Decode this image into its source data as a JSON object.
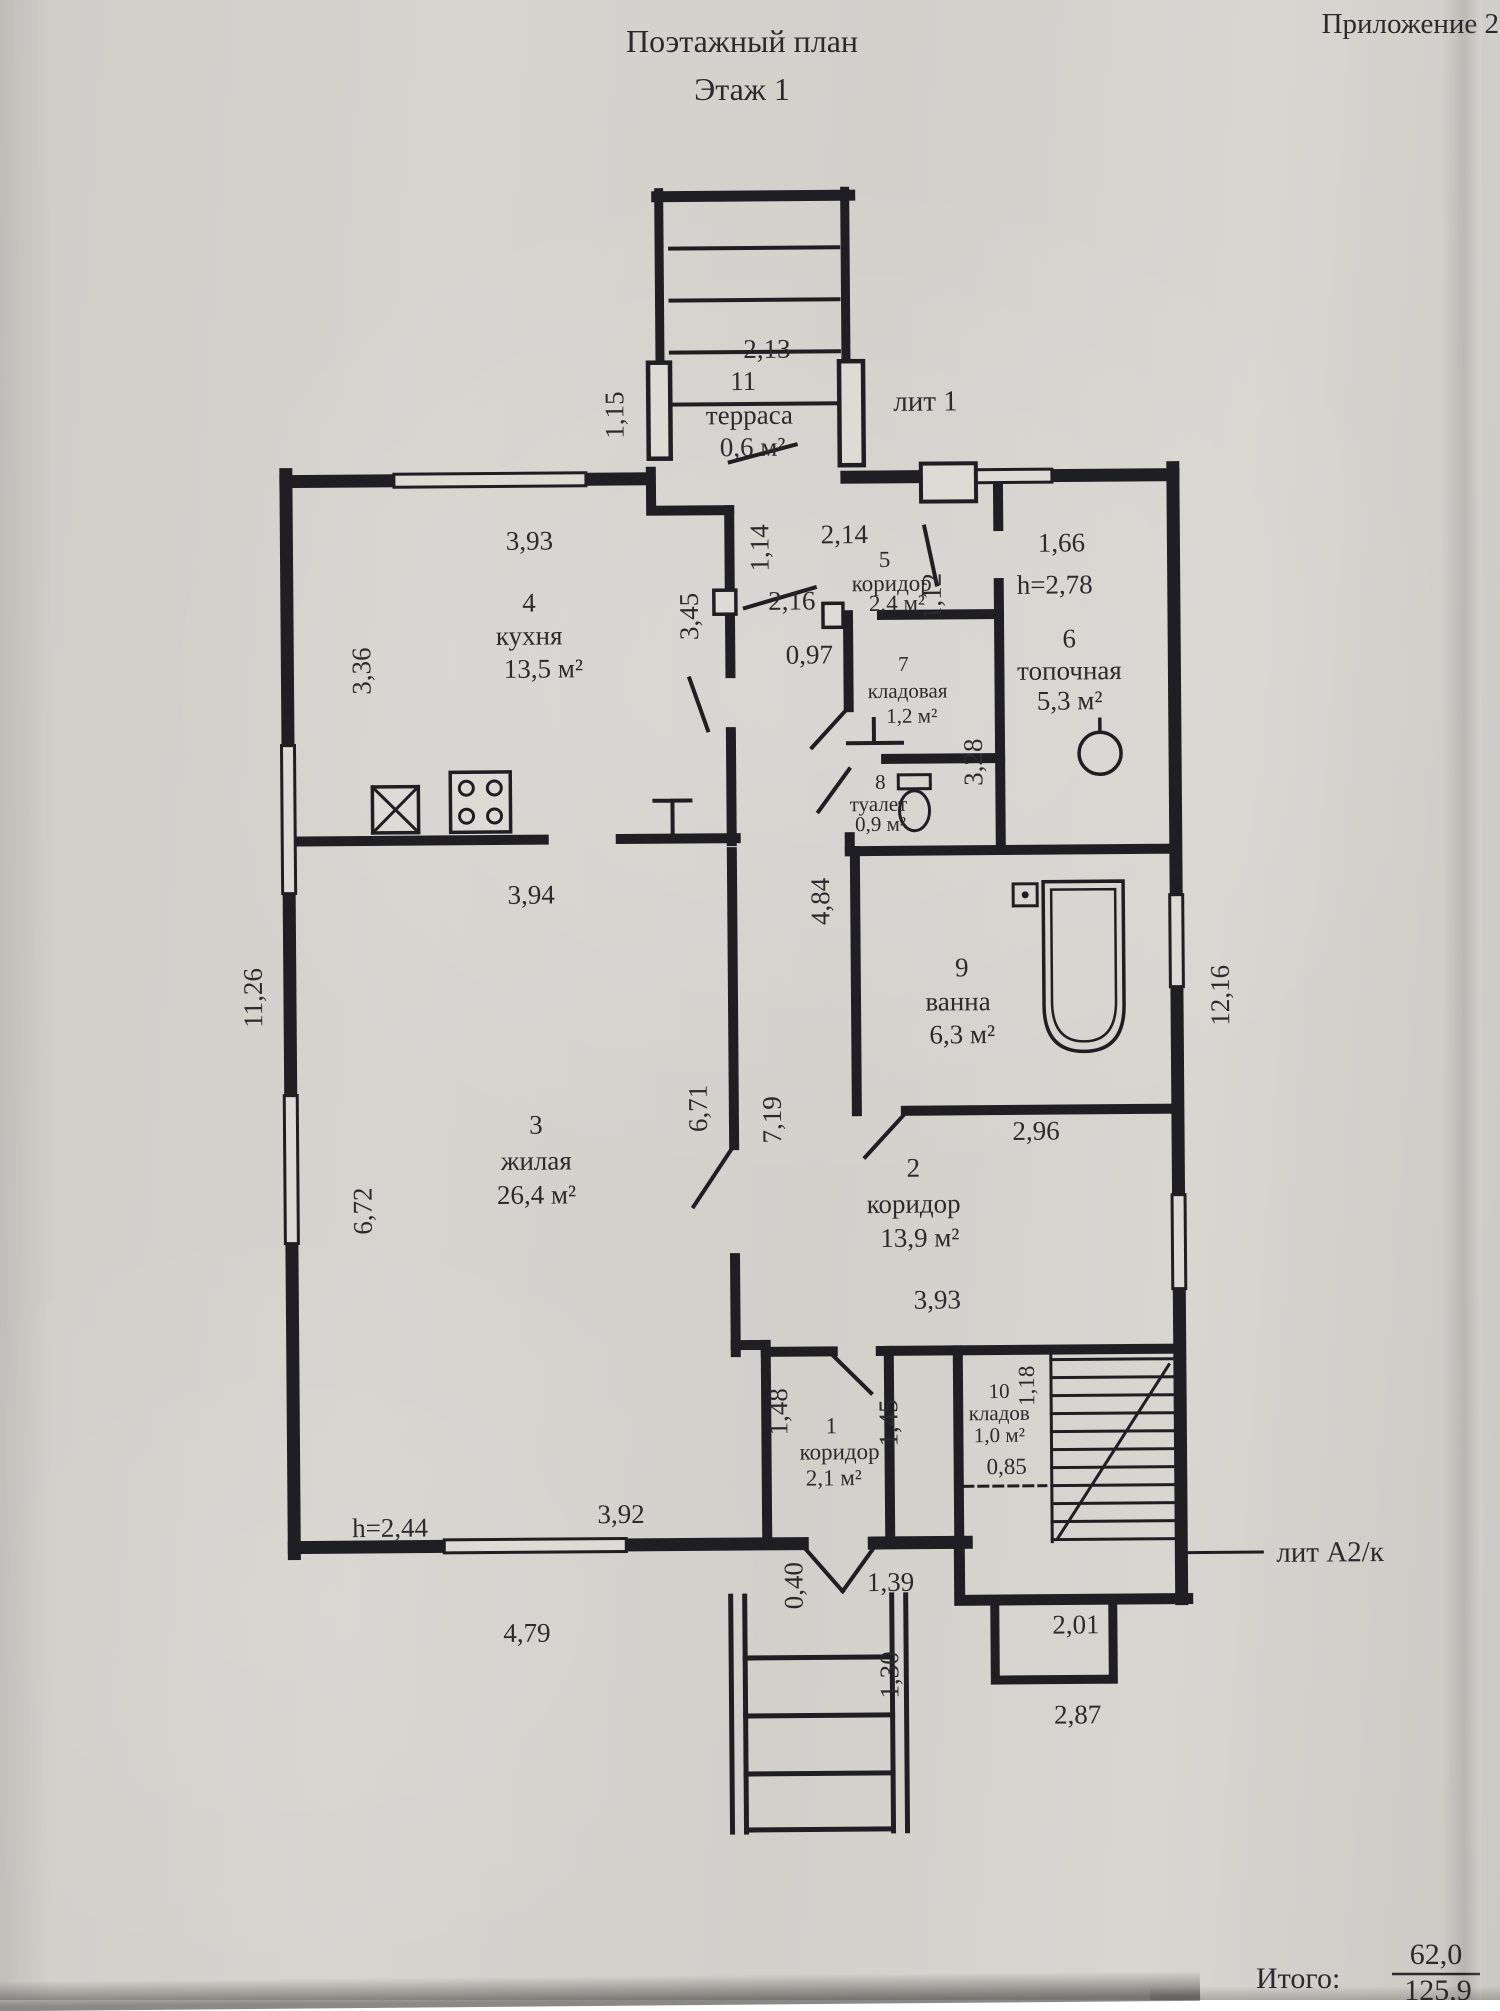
{
  "header": {
    "title": "Поэтажный план",
    "subtitle": "Этаж 1",
    "appendix": "Приложение 2"
  },
  "labels": {
    "lit1": "лит 1",
    "litA2": "лит А2/к"
  },
  "totals": {
    "label": "Итого:",
    "numerator": "62,0",
    "denominator": "125,9"
  },
  "rooms": {
    "r1": {
      "num": "1",
      "name": "коридор",
      "area": "2,1 м²"
    },
    "r2": {
      "num": "2",
      "name": "коридор",
      "area": "13,9 м²"
    },
    "r3": {
      "num": "3",
      "name": "жилая",
      "area": "26,4 м²"
    },
    "r4": {
      "num": "4",
      "name": "кухня",
      "area": "13,5 м²"
    },
    "r5": {
      "num": "5",
      "name": "коридор",
      "area": "2,4 м²"
    },
    "r6": {
      "num": "6",
      "name": "топочная",
      "area": "5,3 м²"
    },
    "r7": {
      "num": "7",
      "name": "кладовая",
      "area": "1,2 м²"
    },
    "r8": {
      "num": "8",
      "name": "туалет",
      "area": "0,9 м²"
    },
    "r9": {
      "num": "9",
      "name": "ванна",
      "area": "6,3 м²"
    },
    "r10": {
      "num": "10",
      "name": "кладов",
      "area": "1,0 м²"
    },
    "r11": {
      "num": "11",
      "name": "терраса",
      "area": "0,6 м²"
    }
  },
  "dims": {
    "v213": "2,13",
    "v115": "1,15",
    "v214": "2,14",
    "v114": "1,14",
    "v166": "1,66",
    "h278": "h=2,78",
    "v393a": "3,93",
    "v345": "3,45",
    "v216": "2,16",
    "v112": "1,12",
    "v097": "0,97",
    "v336": "3,36",
    "v328": "3,28",
    "v484": "4,84",
    "v1126": "11,26",
    "v1216": "12,16",
    "v394": "3,94",
    "v671": "6,71",
    "v719": "7,19",
    "v296": "2,96",
    "v672": "6,72",
    "v393b": "3,93",
    "v148": "1,48",
    "v145": "1,45",
    "v118": "1,18",
    "v085": "0,85",
    "h244": "h=2,44",
    "v392": "3,92",
    "v040": "0,40",
    "v139": "1,39",
    "v479": "4,79",
    "v130": "1,30",
    "v201": "2,01",
    "v287": "2,87"
  }
}
